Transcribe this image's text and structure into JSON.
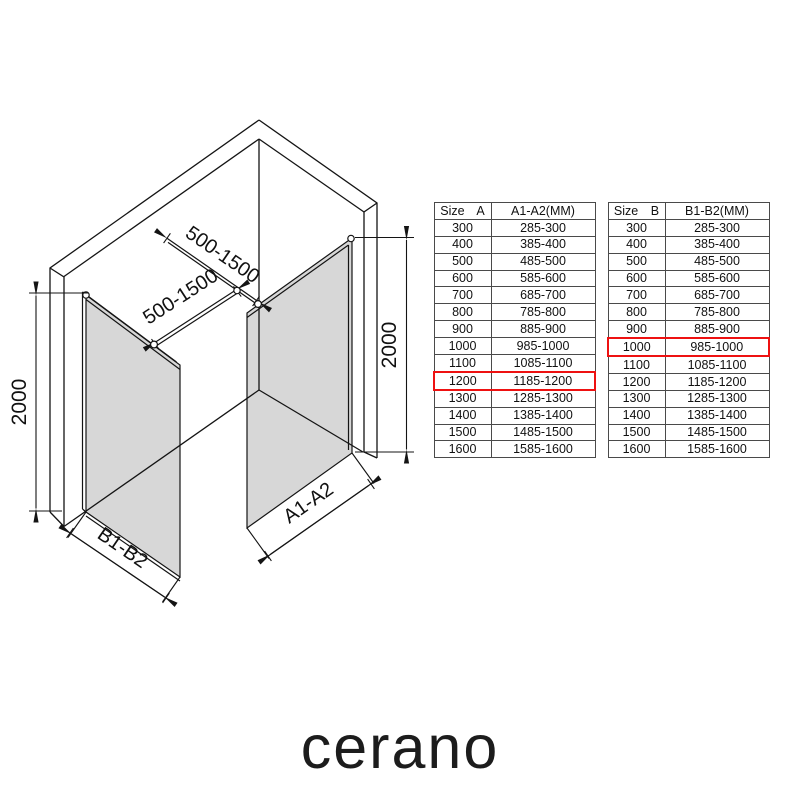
{
  "colors": {
    "glass": "#d7d7d7",
    "line": "#141414",
    "highlight": "#ee1111"
  },
  "logo": {
    "brand": "cerano"
  },
  "diagram": {
    "dims": {
      "bar_top_label": "500-1500",
      "bar_bottom_label": "500-1500",
      "height_left_label": "2000",
      "height_right_label": "2000",
      "panel_right_label": "A1-A2",
      "panel_left_label": "B1-B2"
    }
  },
  "tables": [
    {
      "id": "A",
      "header": [
        "Size A",
        "A1-A2(MM)"
      ],
      "highlight_row": "1200",
      "rows": [
        [
          "300",
          "285-300"
        ],
        [
          "400",
          "385-400"
        ],
        [
          "500",
          "485-500"
        ],
        [
          "600",
          "585-600"
        ],
        [
          "700",
          "685-700"
        ],
        [
          "800",
          "785-800"
        ],
        [
          "900",
          "885-900"
        ],
        [
          "1000",
          "985-1000"
        ],
        [
          "1100",
          "1085-1100"
        ],
        [
          "1200",
          "1185-1200"
        ],
        [
          "1300",
          "1285-1300"
        ],
        [
          "1400",
          "1385-1400"
        ],
        [
          "1500",
          "1485-1500"
        ],
        [
          "1600",
          "1585-1600"
        ]
      ]
    },
    {
      "id": "B",
      "header": [
        "Size B",
        "B1-B2(MM)"
      ],
      "highlight_row": "1000",
      "rows": [
        [
          "300",
          "285-300"
        ],
        [
          "400",
          "385-400"
        ],
        [
          "500",
          "485-500"
        ],
        [
          "600",
          "585-600"
        ],
        [
          "700",
          "685-700"
        ],
        [
          "800",
          "785-800"
        ],
        [
          "900",
          "885-900"
        ],
        [
          "1000",
          "985-1000"
        ],
        [
          "1100",
          "1085-1100"
        ],
        [
          "1200",
          "1185-1200"
        ],
        [
          "1300",
          "1285-1300"
        ],
        [
          "1400",
          "1385-1400"
        ],
        [
          "1500",
          "1485-1500"
        ],
        [
          "1600",
          "1585-1600"
        ]
      ]
    }
  ]
}
